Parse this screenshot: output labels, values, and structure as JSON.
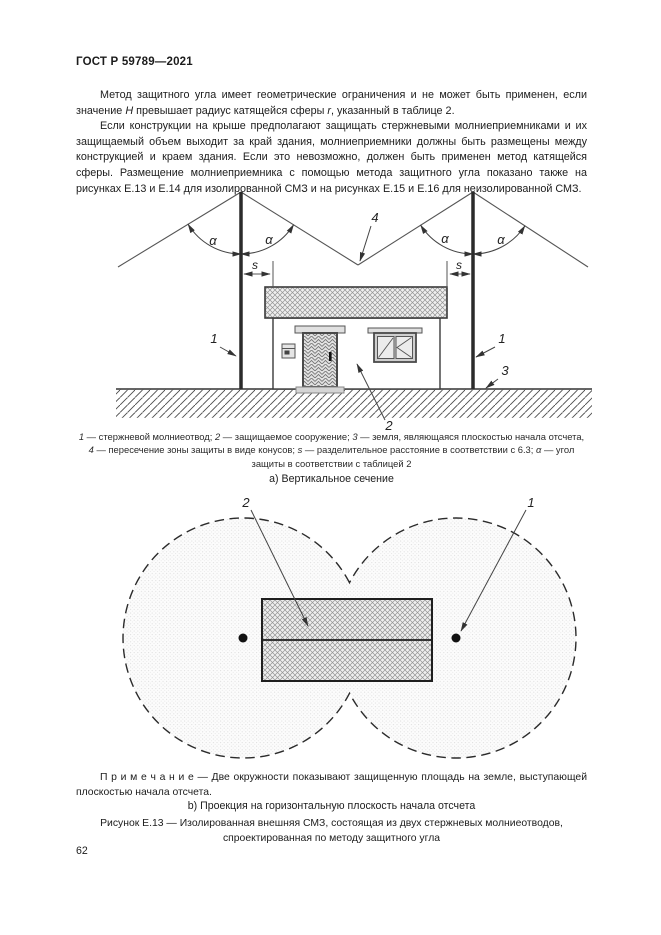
{
  "header": {
    "title": "ГОСТ Р 59789—2021"
  },
  "body": {
    "para1": {
      "t1": "Метод защитного угла имеет геометрические ограничения и не может быть применен, если значение ",
      "var_h": "H",
      "t2": " превышает радиус катящейся сферы ",
      "var_r": "r",
      "t3": ", указанный в таблице 2."
    },
    "para2": "Если конструкции на крыше предполагают защищать стержневыми молниеприемниками и их защищаемый объем выходит за край здания, молниеприемники должны быть размещены между конструкцией и краем здания. Если это невозможно, должен быть применен метод катящейся сферы. Размещение молниеприемника с помощью метода защитного угла показано также на рисунках Е.13 и Е.14 для изолированной СМЗ и на рисунках Е.15 и Е.16 для неизолированной СМЗ."
  },
  "figure_a": {
    "labels": {
      "rod": "1",
      "building": "2",
      "ground": "3",
      "cones": "4",
      "sep": "s",
      "alpha": "α"
    },
    "subcaption": "а) Вертикальное сечение"
  },
  "legend": {
    "items": [
      {
        "key": "1",
        "text": " — стержневой молниеотвод; "
      },
      {
        "key": "2",
        "text": " — защищаемое сооружение; "
      },
      {
        "key": "3",
        "text": " — земля, являющаяся плоскостью начала отсчета, "
      },
      {
        "key": "4",
        "text": " — пересечение зоны защиты в виде конусов; "
      },
      {
        "key": "s",
        "text": " — разделительное расстояние в соответствии с 6.3; "
      },
      {
        "key": "α",
        "text": " — угол защиты в соответствии с таблицей 2"
      }
    ]
  },
  "figure_b": {
    "labels": {
      "building": "2",
      "rod": "1"
    },
    "subcaption": "b) Проекция на горизонтальную плоскость начала отсчета"
  },
  "note": {
    "label": "П р и м е ч а н и е",
    "text": " — Две окружности показывают защищенную площадь на земле, выступающей плоскостью начала отсчета."
  },
  "figure_caption": "Рисунок Е.13 — Изолированная внешняя СМЗ, состоящая из двух стержневых молниеотводов, спроектированная по методу защитного угла",
  "page_number": "62"
}
